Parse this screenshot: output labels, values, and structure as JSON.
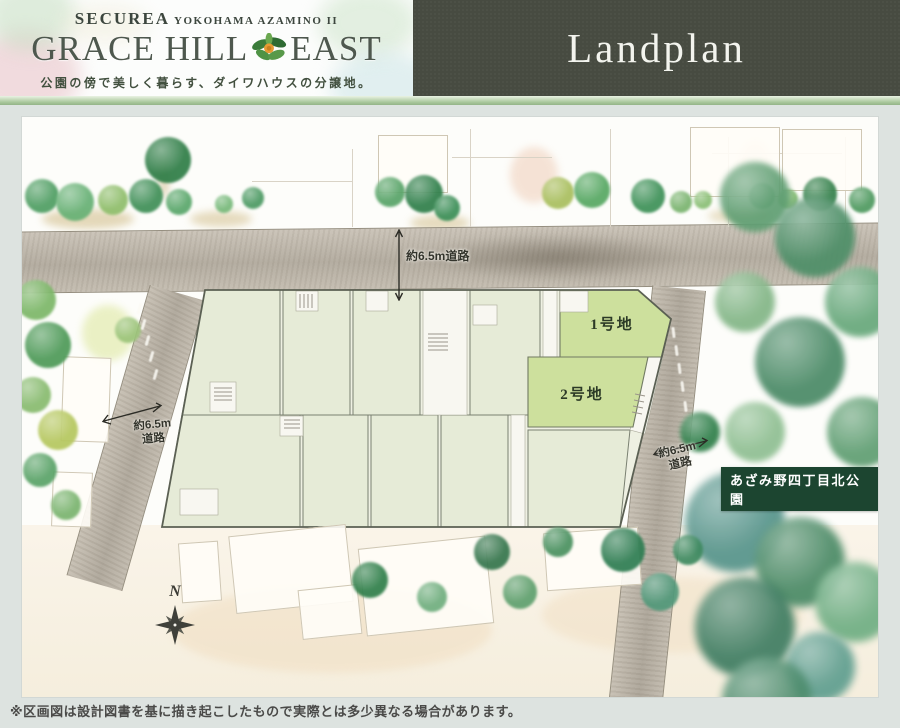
{
  "header": {
    "brand_top_main": "SECUREA",
    "brand_top_sub": "YOKOHAMA AZAMINO II",
    "title_part1": "GRACE HILL",
    "title_part2": "EAST",
    "tagline": "公園の傍で美しく暮らす、ダイワハウスの分譲地。",
    "page_title": "Landplan"
  },
  "map": {
    "top_road_label": "約6.5m道路",
    "left_road_label_line1": "約6.5m",
    "left_road_label_line2": "道路",
    "right_road_label_line1": "約6.5m",
    "right_road_label_line2": "道路",
    "lots": [
      {
        "label": "1号地"
      },
      {
        "label": "2号地"
      }
    ],
    "park_label": "あざみ野四丁目北公園",
    "compass_label": "N"
  },
  "icons": {
    "flower": "flower-icon",
    "compass": "compass-rose-icon",
    "tree": "tree-icon"
  },
  "colors": {
    "header_dark_bg": "#474b41",
    "accent_strip_green": "#a8c69a",
    "page_bg": "#dde3e0",
    "featured_lot_green": "#cde09d",
    "standard_lot_green": "#e6ebd7",
    "park_label_bg": "#1c4530",
    "road_gray": "#bcb5aa"
  },
  "footer": {
    "disclaimer": "※区画図は設計図書を基に描き起こしたもので実際とは多少異なる場合があります。"
  }
}
